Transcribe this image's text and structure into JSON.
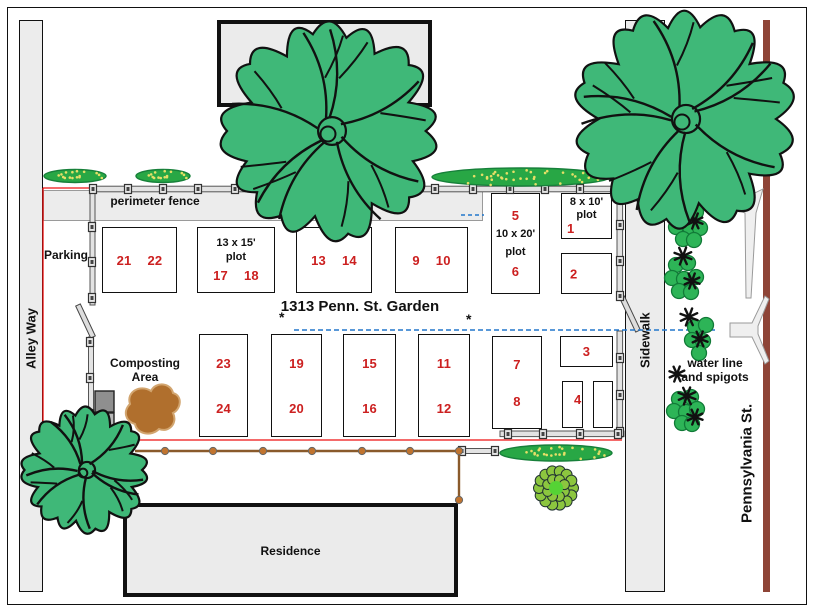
{
  "title": "1313 Penn. St. Garden",
  "streets": {
    "alley_way": "Alley Way",
    "sidewalk": "Sidewalk",
    "pennsylvania": "Pennsylvania St."
  },
  "buildings": {
    "residence_top": "Residence",
    "residence_bottom": "Residence"
  },
  "labels": {
    "perimeter_fence": "perimeter fence",
    "parking": "Parking",
    "composting_area_line1": "Composting",
    "composting_area_line2": "Area",
    "water_line_line1": "water line",
    "water_line_line2": "and spigots",
    "water_marker": "*"
  },
  "plot_sizes": {
    "s1315_line1": "13 x 15'",
    "s1315_line2": "plot",
    "s1020_line1": "10 x 20'",
    "s1020_line2": "plot",
    "s810_line1": "8 x 10'",
    "s810_line2": "plot"
  },
  "plots": {
    "n1": "1",
    "n2": "2",
    "n3": "3",
    "n4": "4",
    "n5": "5",
    "n6": "6",
    "n7": "7",
    "n8": "8",
    "n9": "9",
    "n10": "10",
    "n11": "11",
    "n12": "12",
    "n13": "13",
    "n14": "14",
    "n15": "15",
    "n16": "16",
    "n17": "17",
    "n18": "18",
    "n19": "19",
    "n20": "20",
    "n21": "21",
    "n22": "22",
    "n23": "23",
    "n24": "24"
  },
  "colors": {
    "plot_number_red": "#cc2020",
    "fence_line_red": "#ee1111",
    "water_line_blue": "#2277cc",
    "street_brown": "#8e4437",
    "tree_green": "#3fb878",
    "hedge_green": "#28a745",
    "bush_green": "#2db457",
    "compost_brown": "#b06f2d",
    "wood_fence_brown": "#8a5a2b"
  }
}
